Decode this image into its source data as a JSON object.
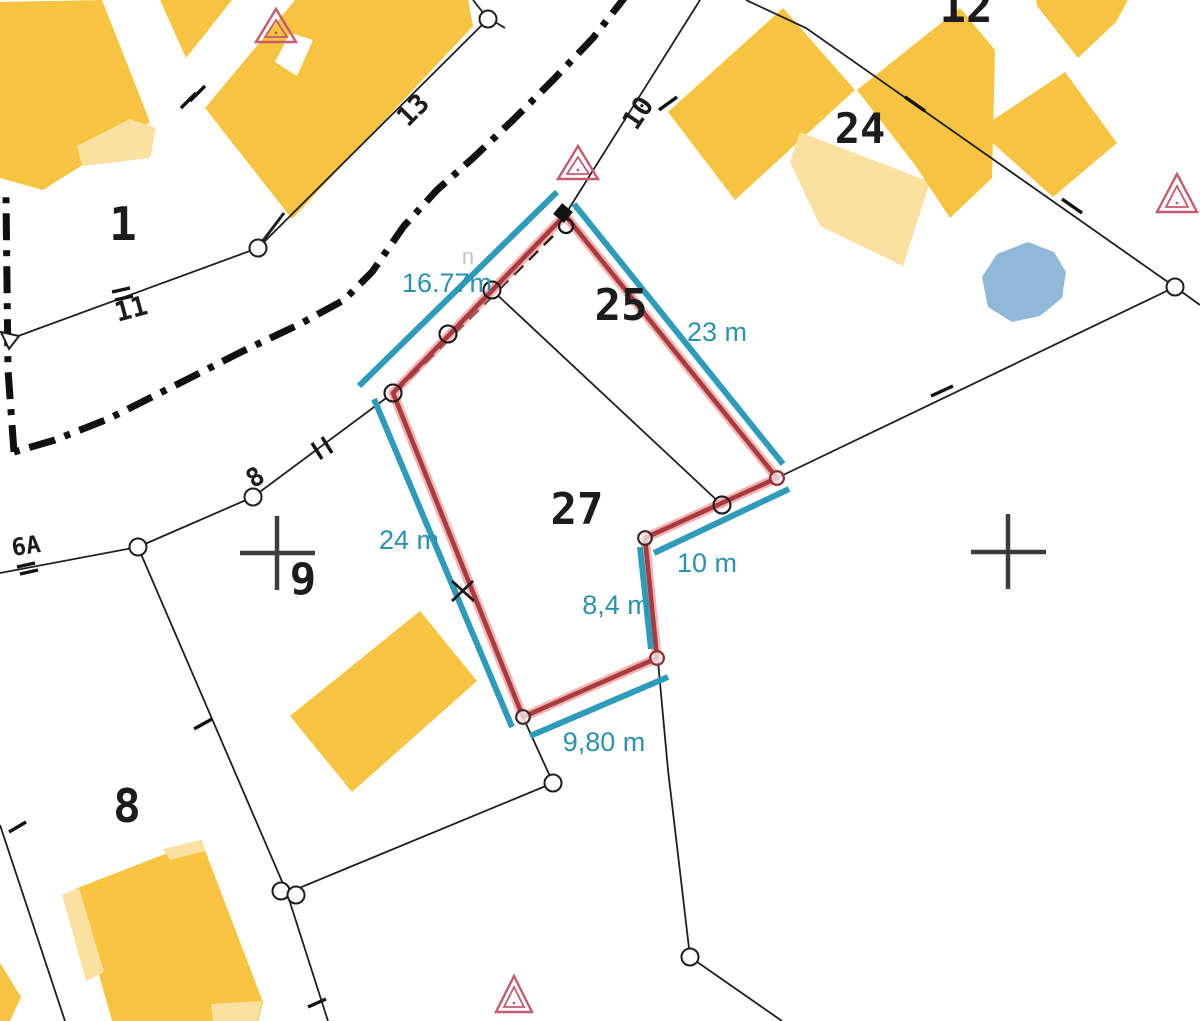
{
  "labels": {
    "parcel_1": "1",
    "parcel_8": "8",
    "parcel_9": "9",
    "parcel_12": "12",
    "parcel_24": "24",
    "parcel_25": "25",
    "parcel_27": "27",
    "line_13": "13",
    "line_11": "11",
    "line_10": "10",
    "house_8": "8",
    "street_6a": "6A",
    "ghost": "n"
  },
  "measurements": {
    "street_edge": "16.77m",
    "east_side": "23 m",
    "west_side": "24 m",
    "jog_north": "10 m",
    "jog_east": "8,4 m",
    "south_side": "9,80 m"
  },
  "colors": {
    "building": "#F6C440",
    "building_annex": "#FAE1A1",
    "pond": "#8FB9D6",
    "highlight_red": "#A93A3E",
    "measure_teal": "#2E9BBB",
    "triangle_pink": "#C45B6E"
  }
}
